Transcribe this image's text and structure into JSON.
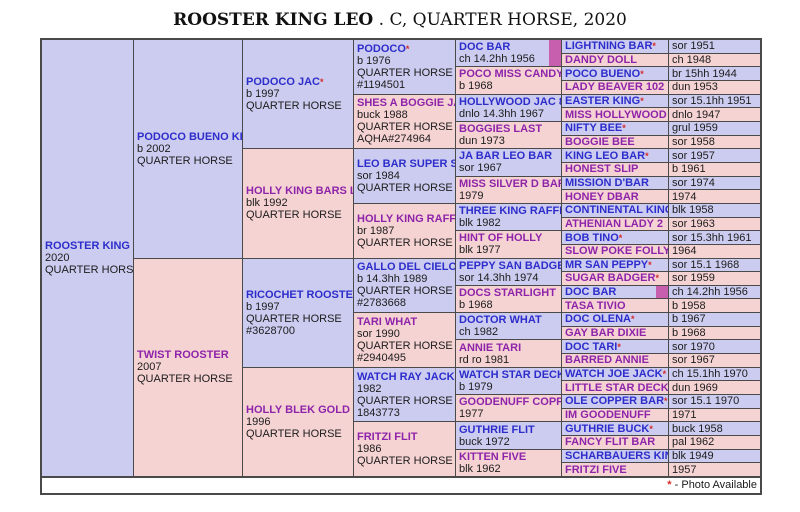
{
  "title": {
    "name": "ROOSTER KING LEO",
    "suffix": " . C, QUARTER HORSE, 2020"
  },
  "footer": {
    "star": "*",
    "text": " - Photo Available"
  },
  "colors": {
    "sire_bg": "#ccccf0",
    "dam_bg": "#f6d3d3",
    "sire_name": "#2d2dcc",
    "dam_name": "#8e24aa",
    "star": "#d42a2a",
    "photo_indicator": "#c75fae",
    "grid_line": "#4a4a4a"
  },
  "gen1": [
    {
      "name": "ROOSTER KING LEO",
      "star": "",
      "sex": "s",
      "lines": [
        "2020",
        "QUARTER HORSE"
      ]
    }
  ],
  "gen2": [
    {
      "name": "PODOCO BUENO KING",
      "star": "*",
      "sex": "s",
      "lines": [
        "b 2002",
        "QUARTER HORSE"
      ]
    },
    {
      "name": "TWIST ROOSTER",
      "star": "",
      "sex": "d",
      "lines": [
        "2007",
        "QUARTER HORSE"
      ]
    }
  ],
  "gen3": [
    {
      "name": "PODOCO JAC",
      "star": "*",
      "sex": "s",
      "lines": [
        "b 1997",
        "QUARTER HORSE"
      ]
    },
    {
      "name": "HOLLY KING BARS LADY",
      "star": "",
      "sex": "d",
      "lines": [
        "blk 1992",
        "QUARTER HORSE"
      ]
    },
    {
      "name": "RICOCHET ROOSTER",
      "star": "",
      "sex": "s",
      "lines": [
        "b 1997",
        "QUARTER HORSE",
        "#3628700"
      ]
    },
    {
      "name": "HOLLY BLEK GOLD",
      "star": "",
      "sex": "d",
      "lines": [
        "1996",
        "QUARTER HORSE"
      ]
    }
  ],
  "gen4": [
    {
      "name": "PODOCO",
      "star": "*",
      "sex": "s",
      "lines": [
        "b 1976",
        "QUARTER HORSE",
        "#1194501"
      ]
    },
    {
      "name": "SHES A BOGGIE JAC",
      "star": "",
      "sex": "d",
      "lines": [
        "buck 1988",
        "QUARTER HORSE",
        "AQHA#274964"
      ]
    },
    {
      "name": "LEO BAR SUPER STAR",
      "star": "",
      "sex": "s",
      "lines": [
        "sor 1984",
        "QUARTER HORSE"
      ]
    },
    {
      "name": "HOLLY KING RAFFLES",
      "star": "",
      "sex": "d",
      "lines": [
        "br 1987",
        "QUARTER HORSE"
      ]
    },
    {
      "name": "GALLO DEL CIELO",
      "star": "",
      "sex": "s",
      "lines": [
        "b 14.3hh 1989",
        "QUARTER HORSE",
        "#2783668"
      ]
    },
    {
      "name": "TARI WHAT",
      "star": "",
      "sex": "d",
      "lines": [
        "sor 1990",
        "QUARTER HORSE",
        "#2940495"
      ]
    },
    {
      "name": "WATCH RAY JACK",
      "star": "",
      "sex": "s",
      "lines": [
        "1982",
        "QUARTER HORSE",
        "1843773"
      ]
    },
    {
      "name": "FRITZI FLIT",
      "star": "",
      "sex": "d",
      "lines": [
        "1986",
        "QUARTER HORSE"
      ]
    }
  ],
  "gen5": [
    {
      "name": "DOC BAR",
      "star": "",
      "sex": "s",
      "photo": true,
      "lines": [
        "ch 14.2hh 1956"
      ]
    },
    {
      "name": "POCO MISS CANDY",
      "star": "",
      "sex": "d",
      "lines": [
        "b 1968"
      ]
    },
    {
      "name": "HOLLYWOOD JAC 862",
      "star": "*",
      "sex": "s",
      "lines": [
        "dnlo 14.3hh 1967"
      ]
    },
    {
      "name": "BOGGIES LAST",
      "star": "",
      "sex": "d",
      "lines": [
        "dun 1973"
      ]
    },
    {
      "name": "JA BAR LEO BAR",
      "star": "",
      "sex": "s",
      "lines": [
        "sor 1967"
      ]
    },
    {
      "name": "MISS SILVER D BAR",
      "star": "",
      "sex": "d",
      "lines": [
        "1979"
      ]
    },
    {
      "name": "THREE KING RAFFLES",
      "star": "*",
      "sex": "s",
      "lines": [
        "blk 1982"
      ]
    },
    {
      "name": "HINT OF HOLLY",
      "star": "",
      "sex": "d",
      "lines": [
        "blk 1977"
      ]
    },
    {
      "name": "PEPPY SAN BADGER",
      "star": "*",
      "sex": "s",
      "lines": [
        "sor 14.3hh 1974"
      ]
    },
    {
      "name": "DOCS STARLIGHT",
      "star": "",
      "sex": "d",
      "lines": [
        "b 1968"
      ]
    },
    {
      "name": "DOCTOR WHAT",
      "star": "",
      "sex": "s",
      "lines": [
        "ch 1982"
      ]
    },
    {
      "name": "ANNIE TARI",
      "star": "",
      "sex": "d",
      "lines": [
        "rd ro 1981"
      ]
    },
    {
      "name": "WATCH STAR DECK",
      "star": "",
      "sex": "s",
      "lines": [
        "b 1979"
      ]
    },
    {
      "name": "GOODENUFF COPPER",
      "star": "",
      "sex": "d",
      "lines": [
        "1977"
      ]
    },
    {
      "name": "GUTHRIE FLIT",
      "star": "",
      "sex": "s",
      "lines": [
        "buck 1972"
      ]
    },
    {
      "name": "KITTEN FIVE",
      "star": "",
      "sex": "d",
      "lines": [
        "blk 1962"
      ]
    }
  ],
  "gen6": [
    {
      "name": "LIGHTNING BAR",
      "star": "*",
      "sex": "s",
      "date": "sor 1951"
    },
    {
      "name": "DANDY DOLL",
      "star": "",
      "sex": "d",
      "date": "ch 1948"
    },
    {
      "name": "POCO BUENO",
      "star": "*",
      "sex": "s",
      "date": "br 15hh 1944"
    },
    {
      "name": "LADY BEAVER 102",
      "star": "",
      "sex": "d",
      "date": "dun 1953"
    },
    {
      "name": "EASTER KING",
      "star": "*",
      "sex": "s",
      "date": "sor 15.1hh 1951"
    },
    {
      "name": "MISS HOLLYWOOD",
      "star": "",
      "sex": "d",
      "date": "dnlo 1947"
    },
    {
      "name": "NIFTY BEE",
      "star": "*",
      "sex": "s",
      "date": "grul 1959"
    },
    {
      "name": "BOGGIE BEE",
      "star": "",
      "sex": "d",
      "date": "sor 1958"
    },
    {
      "name": "KING LEO BAR",
      "star": "*",
      "sex": "s",
      "date": "sor 1957"
    },
    {
      "name": "HONEST SLIP",
      "star": "",
      "sex": "d",
      "date": "b 1961"
    },
    {
      "name": "MISSION D'BAR",
      "star": "",
      "sex": "s",
      "date": "sor 1974"
    },
    {
      "name": "HONEY DBAR",
      "star": "",
      "sex": "d",
      "date": "1974"
    },
    {
      "name": "CONTINENTAL KING",
      "star": "*",
      "sex": "s",
      "date": "blk 1958"
    },
    {
      "name": "ATHENIAN LADY 2",
      "star": "",
      "sex": "d",
      "date": "sor 1963"
    },
    {
      "name": "BOB TINO",
      "star": "*",
      "sex": "s",
      "date": "sor 15.3hh 1961"
    },
    {
      "name": "SLOW POKE FOLLY",
      "star": "",
      "sex": "d",
      "date": "1964"
    },
    {
      "name": "MR SAN PEPPY",
      "star": "*",
      "sex": "s",
      "date": "sor 15.1 1968"
    },
    {
      "name": "SUGAR BADGER",
      "star": "*",
      "sex": "d",
      "date": "sor 1959"
    },
    {
      "name": "DOC BAR",
      "star": "",
      "sex": "s",
      "photo": true,
      "date": "ch 14.2hh 1956"
    },
    {
      "name": "TASA TIVIO",
      "star": "",
      "sex": "d",
      "date": "b 1958"
    },
    {
      "name": "DOC OLENA",
      "star": "*",
      "sex": "s",
      "date": "b 1967"
    },
    {
      "name": "GAY BAR DIXIE",
      "star": "",
      "sex": "d",
      "date": "b 1968"
    },
    {
      "name": "DOC TARI",
      "star": "*",
      "sex": "s",
      "date": "sor 1970"
    },
    {
      "name": "BARRED ANNIE",
      "star": "",
      "sex": "d",
      "date": "sor 1967"
    },
    {
      "name": "WATCH JOE JACK",
      "star": "*",
      "sex": "s",
      "date": "ch 15.1hh 1970"
    },
    {
      "name": "LITTLE STAR DECK",
      "star": "",
      "sex": "d",
      "date": "dun 1969"
    },
    {
      "name": "OLE COPPER BAR",
      "star": "*",
      "sex": "s",
      "date": "sor 15.1 1970"
    },
    {
      "name": "IM GOODENUFF",
      "star": "",
      "sex": "d",
      "date": "1971"
    },
    {
      "name": "GUTHRIE BUCK",
      "star": "*",
      "sex": "s",
      "date": "buck 1958"
    },
    {
      "name": "FANCY FLIT BAR",
      "star": "",
      "sex": "d",
      "date": "pal 1962"
    },
    {
      "name": "SCHARBAUERS KING",
      "star": "",
      "sex": "s",
      "date": "blk 1949"
    },
    {
      "name": "FRITZI FIVE",
      "star": "",
      "sex": "d",
      "date": "1957"
    }
  ]
}
